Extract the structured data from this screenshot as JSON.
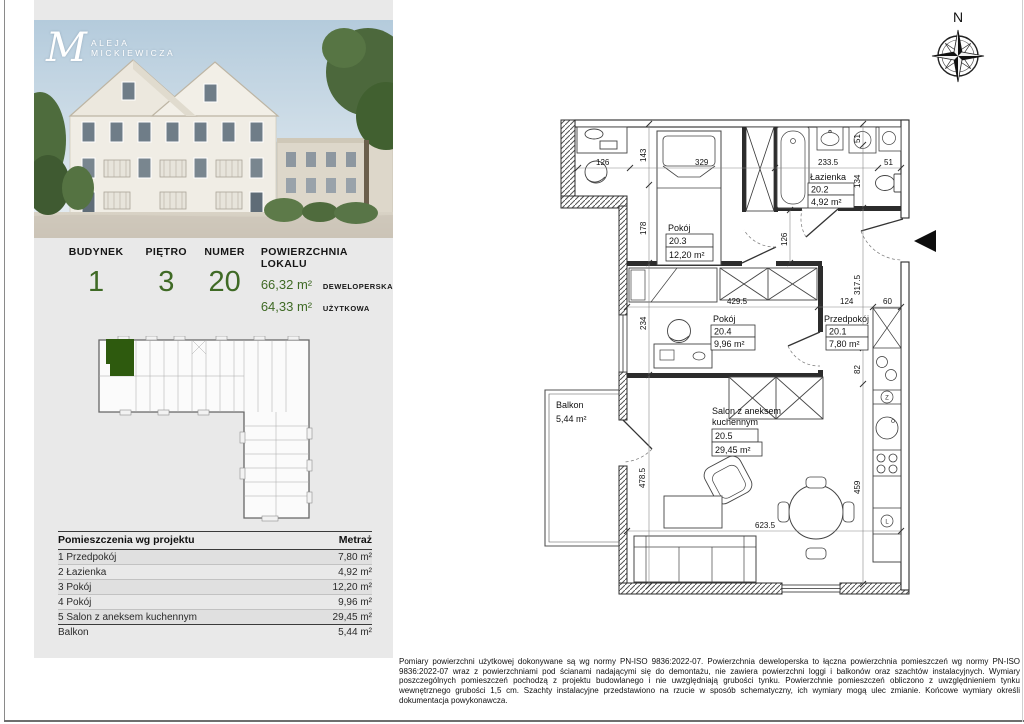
{
  "left_panel": {
    "logo": {
      "monogram": "M",
      "line1": "ALEJA",
      "line2": "MICKIEWICZA"
    },
    "info": {
      "budynek_label": "BUDYNEK",
      "budynek_value": "1",
      "pietro_label": "PIĘTRO",
      "pietro_value": "3",
      "numer_label": "NUMER",
      "numer_value": "20",
      "powierzchnia_label": "POWIERZCHNIA LOKALU",
      "area1_value": "66,32 m²",
      "area1_type": "DEWELOPERSKA",
      "area2_value": "64,33 m²",
      "area2_type": "UŻYTKOWA"
    },
    "table": {
      "header_room": "Pomieszczenia wg projektu",
      "header_area": "Metraż",
      "rows": [
        {
          "name": "1 Przedpokój",
          "area": "7,80 m²"
        },
        {
          "name": "2 Łazienka",
          "area": "4,92 m²"
        },
        {
          "name": "3 Pokój",
          "area": "12,20 m²"
        },
        {
          "name": "4 Pokój",
          "area": "9,96 m²"
        },
        {
          "name": "5 Salon z aneksem kuchennym",
          "area": "29,45 m²"
        },
        {
          "name": "Balkon",
          "area": "5,44 m²"
        }
      ]
    },
    "accent_green": "#3f6a25",
    "highlight_green": "#2e5a0e"
  },
  "floor_plan": {
    "compass": {
      "north_label": "N"
    },
    "rooms": [
      {
        "name": "Pokój",
        "number": "20.3",
        "area": "12,20 m²"
      },
      {
        "name": "Łazienka",
        "number": "20.2",
        "area": "4,92 m²"
      },
      {
        "name": "Pokój",
        "number": "20.4",
        "area": "9,96 m²"
      },
      {
        "name": "Przedpokój",
        "number": "20.1",
        "area": "7,80 m²"
      },
      {
        "name": "Salon z aneksem kuchennym",
        "name_line1": "Salon z aneksem",
        "name_line2": "kuchennym",
        "number": "20.5",
        "area": "29,45 m²"
      }
    ],
    "balcony": {
      "name": "Balkon",
      "area": "5,44 m²"
    },
    "kitchen": {
      "dishwasher_letter": "Z",
      "fridge_letter": "L"
    },
    "dims": {
      "top_126": "126",
      "top_329": "329",
      "top_233_5": "233.5",
      "top_51": "51",
      "left_143": "143",
      "left_178": "178",
      "left_234": "234",
      "left_478_5": "478.5",
      "mid_429_5": "429.5",
      "mid_124": "124",
      "mid_60": "60",
      "right_51": "51",
      "right_134": "134",
      "right_317_5": "317.5",
      "right_82": "82",
      "right_459": "459",
      "hall_126": "126",
      "bottom_623_5": "623.5"
    }
  },
  "footer": {
    "disclaimer": "Pomiary powierzchni użytkowej dokonywane są wg normy PN-ISO 9836:2022-07. Powierzchnia deweloperska to łączna powierzchnia pomieszczeń wg normy PN-ISO 9836:2022-07 wraz z powierzchniami pod ścianami nadającymi się do demontażu, nie zawiera powierzchni loggi i balkonów oraz szachtów instalacyjnych. Wymiary poszczególnych pomieszczeń pochodzą z projektu budowlanego i nie uwzględniają grubości tynku. Powierzchnie pomieszczeń obliczono z uwzględnieniem tynku wewnętrznego grubości 1,5 cm. Szachty instalacyjne przedstawiono na rzucie w sposób schematyczny, ich wymiary mogą ulec zmianie. Końcowe wymiary określi dokumentacja powykonawcza."
  }
}
